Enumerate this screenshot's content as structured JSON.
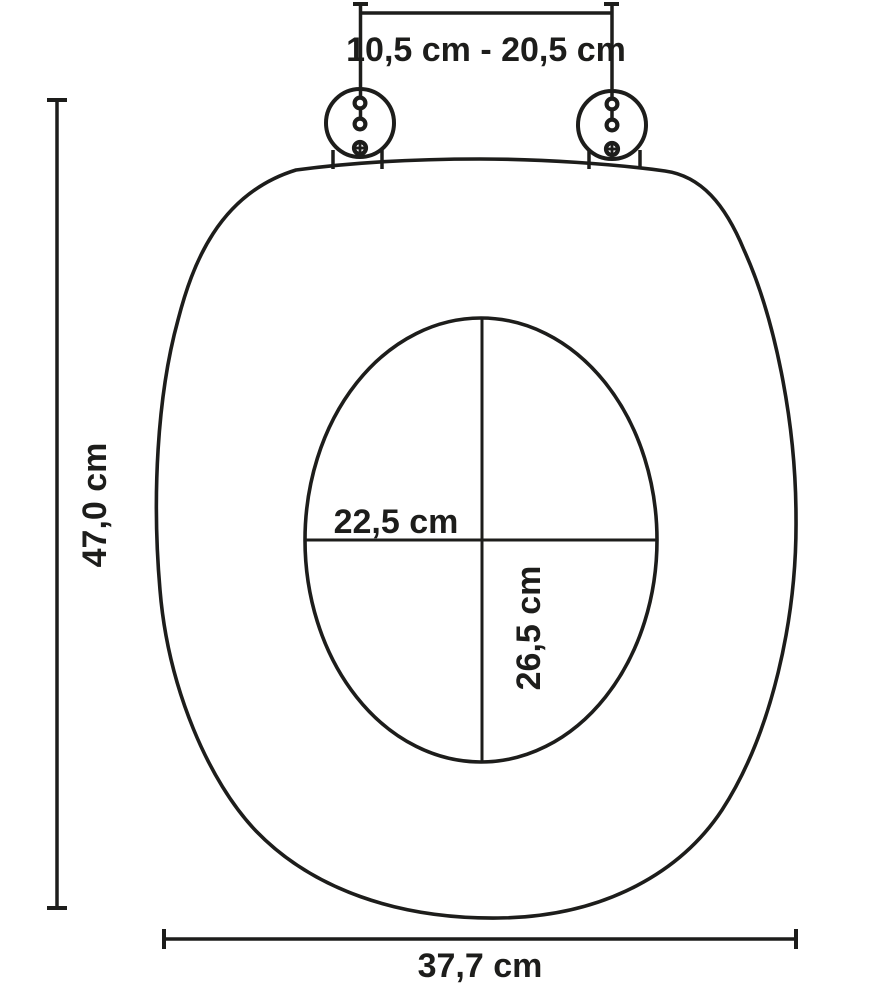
{
  "diagram": {
    "labels": {
      "hinge_distance": "10,5 cm - 20,5 cm",
      "total_length": "47,0 cm",
      "inner_width": "22,5 cm",
      "inner_depth": "26,5 cm",
      "total_width": "37,7 cm"
    },
    "colors": {
      "line": "#1d1d1b",
      "background": "#ffffff"
    }
  }
}
